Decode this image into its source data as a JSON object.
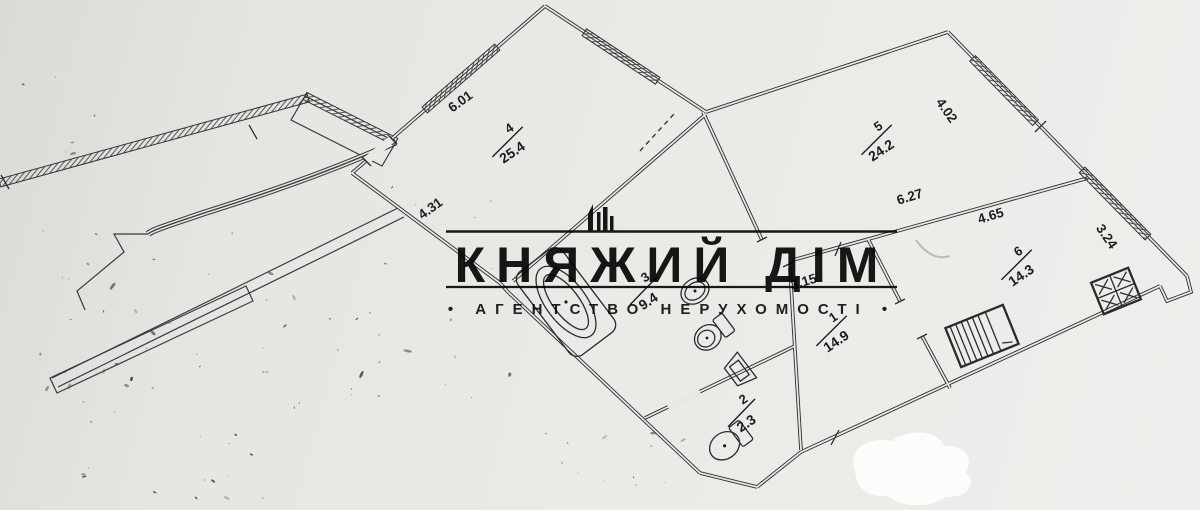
{
  "watermark": {
    "title": "КНЯЖИЙ ДІМ",
    "subtitle": "• АГЕНТСТВО НЕРУХОМОСТІ •",
    "logo": "castle-towers-icon"
  },
  "rooms": [
    {
      "number": "4",
      "area": "25.4"
    },
    {
      "number": "5",
      "area": "24.2"
    },
    {
      "number": "6",
      "area": "14.3"
    },
    {
      "number": "1",
      "area": "14.9"
    },
    {
      "number": "2",
      "area": "2.3"
    },
    {
      "number": "3",
      "area": "9.4"
    }
  ],
  "dimensions": [
    {
      "label": "6.01"
    },
    {
      "label": "4.31"
    },
    {
      "label": "4.02"
    },
    {
      "label": "6.27"
    },
    {
      "label": "4.65"
    },
    {
      "label": "3.24"
    },
    {
      "label": "3.15"
    }
  ],
  "colors": {
    "ink": "#2c2c2c",
    "paper": "#e9e7e3",
    "watermark_ink": "#181818",
    "whiteout": "#fcfcfa"
  }
}
